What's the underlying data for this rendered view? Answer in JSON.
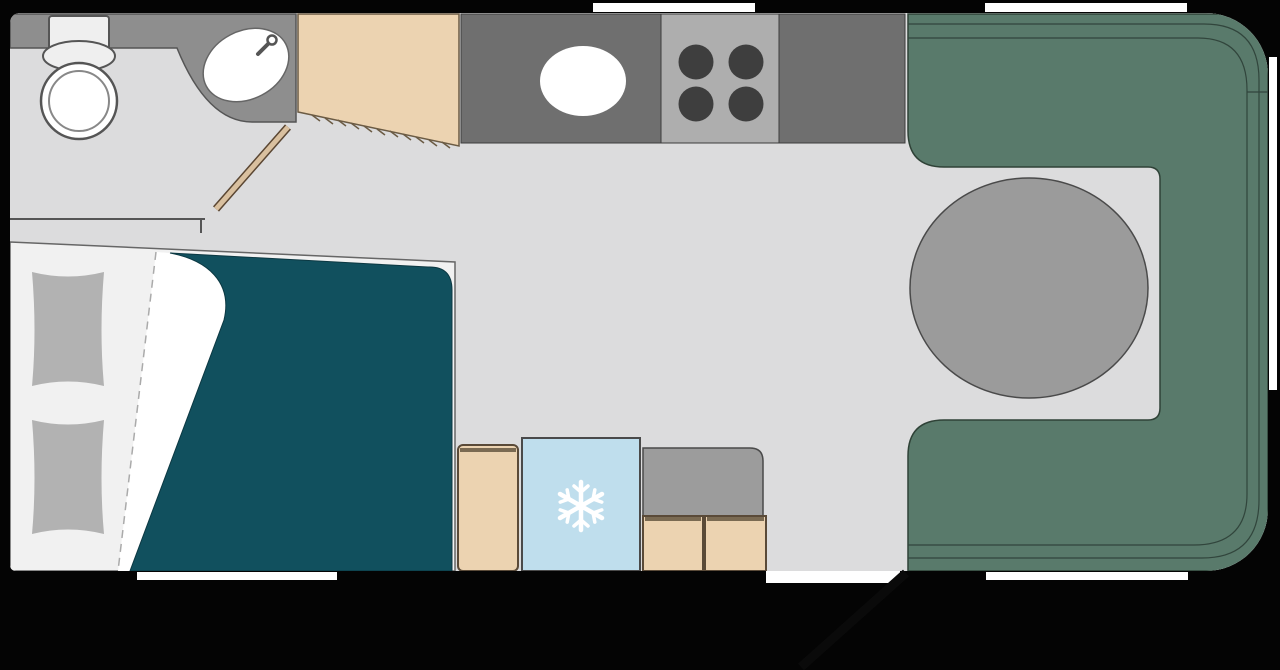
{
  "title": "Caravan floor plan",
  "colors": {
    "wall": "#040404",
    "floor": "#dcdcdd",
    "window": "#ffffff",
    "bathroom_counter": "#8e8e8e",
    "fixture_white": "#ffffff",
    "fixture_light": "#efefef",
    "kitchen_counter": "#6f6f6f",
    "hob": "#aeaeae",
    "burner": "#3e3e3e",
    "wood": "#ecd3b1",
    "wood_edge": "#6b5b44",
    "sofa": "#597a6b",
    "sofa_seam": "#31453c",
    "table": "#9b9b9b",
    "duvet": "#11505e",
    "bed_base": "#f1f1f1",
    "pillow": "#b2b2b2",
    "fridge": "#bfdeed",
    "door_leaf": "#d9c09f",
    "outline": "#4a4a4a"
  },
  "areas": {
    "bathroom": {
      "label": "washroom with toilet and corner basin"
    },
    "wardrobe": {
      "label": "wardrobe"
    },
    "kitchen": {
      "label": "kitchen with sink and four-burner hob"
    },
    "bedroom": {
      "label": "bed with duvet and two pillows"
    },
    "galley_units": {
      "label": "cabinet, refrigerator and drawer unit"
    },
    "lounge": {
      "label": "U-shaped rear lounge with round table"
    },
    "entry": {
      "label": "entry door shown open"
    }
  },
  "icons": {
    "fridge": "snowflake"
  },
  "windows": {
    "count": 5
  }
}
